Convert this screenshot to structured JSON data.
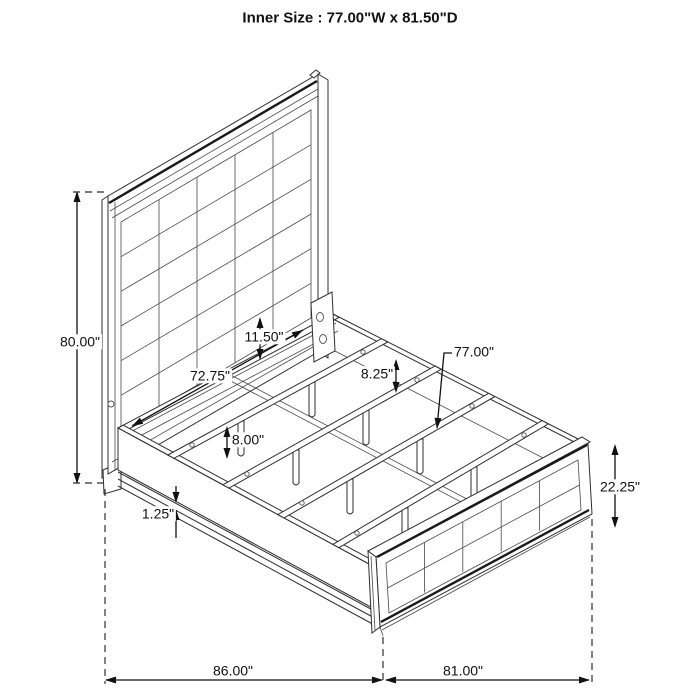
{
  "title": "Inner Size : 77.00\"W x 81.50\"D",
  "colors": {
    "line": "#2f2f2f",
    "text": "#111111",
    "background": "#ffffff"
  },
  "dimensions": {
    "headboard_height": "80.00\"",
    "headboard_inner_width": "72.75\"",
    "headboard_bottom_section": "11.50\"",
    "rail_to_slat": "8.25\"",
    "slat_length": "77.00\"",
    "slat_support_height": "8.00\"",
    "rail_trim_thickness": "1.25\"",
    "footboard_height": "22.25\"",
    "overall_depth": "86.00\"",
    "overall_width": "81.00\""
  }
}
